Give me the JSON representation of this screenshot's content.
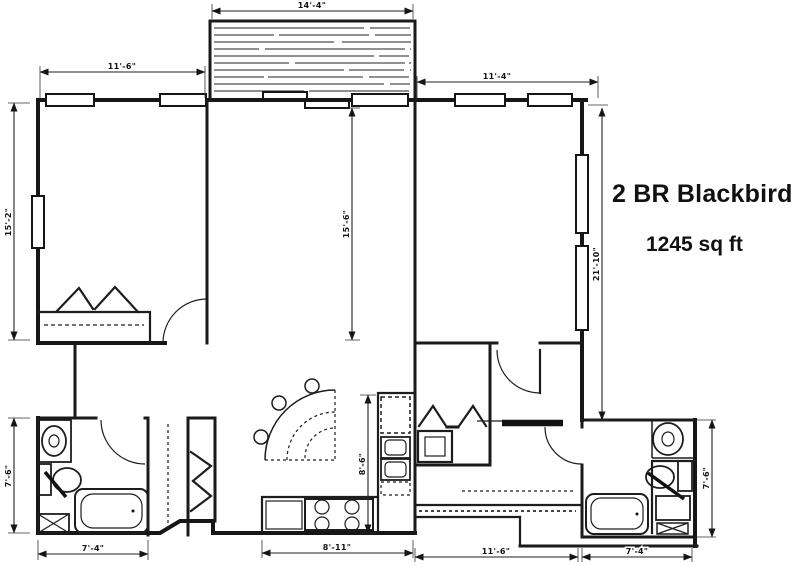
{
  "title": {
    "prefix": "2 BR",
    "name": "Blackbird",
    "area": "1245 sq ft"
  },
  "plan": {
    "type": "architectural floor plan (scanned black line drawing)",
    "rooms": [
      "bedroom left",
      "living / dining",
      "bedroom right",
      "kitchen",
      "bathroom left",
      "bathroom right",
      "entry hall",
      "balcony deck",
      "closets"
    ],
    "fixtures": [
      "bathtub x2",
      "toilet x2",
      "pedestal sink x2",
      "vanity cabinet x2",
      "kitchen double sink",
      "range 4 burners",
      "refrigerator",
      "fan dining table with 3 chairs",
      "bifold closet doors",
      "door swing arcs",
      "windows",
      "sliding balcony door",
      "balcony hatch"
    ]
  },
  "dimensions": {
    "balcony_width": "14'-4\"",
    "bedroom_left_width": "11'-6\"",
    "bedroom_right_width": "11'-4\"",
    "left_side_depth": "15'-2\"",
    "living_depth": "15'-6\"",
    "right_side_depth": "21'-10\"",
    "kitchen_depth": "8'-6\"",
    "bath_left_depth": "7'-6\"",
    "bath_right_depth": "7'-6\"",
    "bath_left_width": "7'-4\"",
    "kitchen_width": "8'-11\"",
    "entry_width": "11'-6\"",
    "bath_right_width": "7'-4\""
  },
  "colors": {
    "ink": "#1a1a1a",
    "paper": "#ffffff"
  }
}
